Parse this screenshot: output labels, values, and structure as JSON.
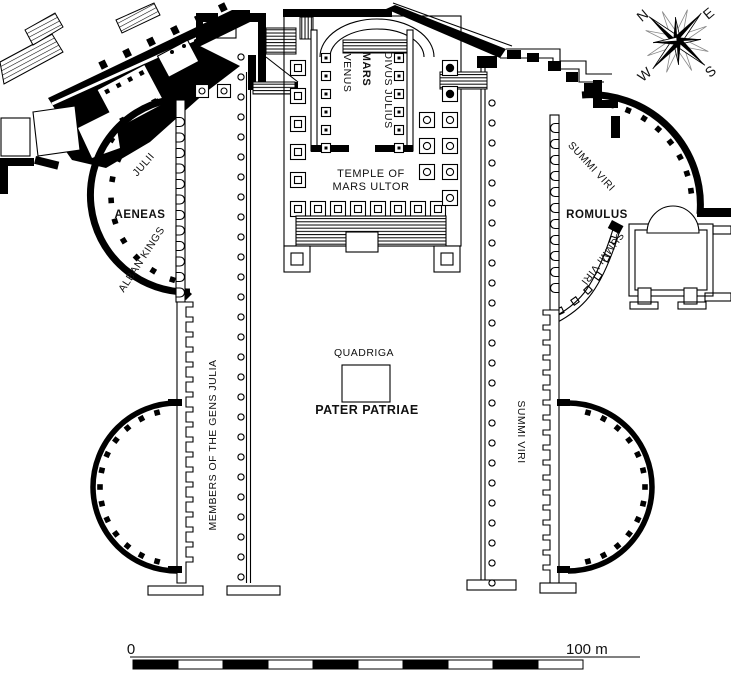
{
  "title": "Plan of the Forum of Augustus with Temple of Mars Ultor",
  "labels": {
    "temple_line1": "TEMPLE OF",
    "temple_line2": "MARS ULTOR",
    "mars": "MARS",
    "venus": "VENUS",
    "divus_julius": "DIVUS JULIUS",
    "aeneas": "AENEAS",
    "julii": "JULII",
    "alban_kings": "ALBAN KINGS",
    "gens_julia": "MEMBERS OF THE GENS JULIA",
    "quadriga": "QUADRIGA",
    "pater_patriae": "PATER PATRIAE",
    "summi_viri_right_portico": "SUMMI VIRI",
    "summi_viri_ne_upper": "SUMMI VIRI",
    "summi_viri_ne_lower": "SUMMI VIRI",
    "romulus": "ROMULUS"
  },
  "compass": {
    "n": "N",
    "e": "E",
    "s": "S",
    "w": "W"
  },
  "scale_bar": {
    "start_label": "0",
    "end_label": "100 m"
  },
  "colors": {
    "ink": "#000000",
    "paper": "#ffffff"
  }
}
